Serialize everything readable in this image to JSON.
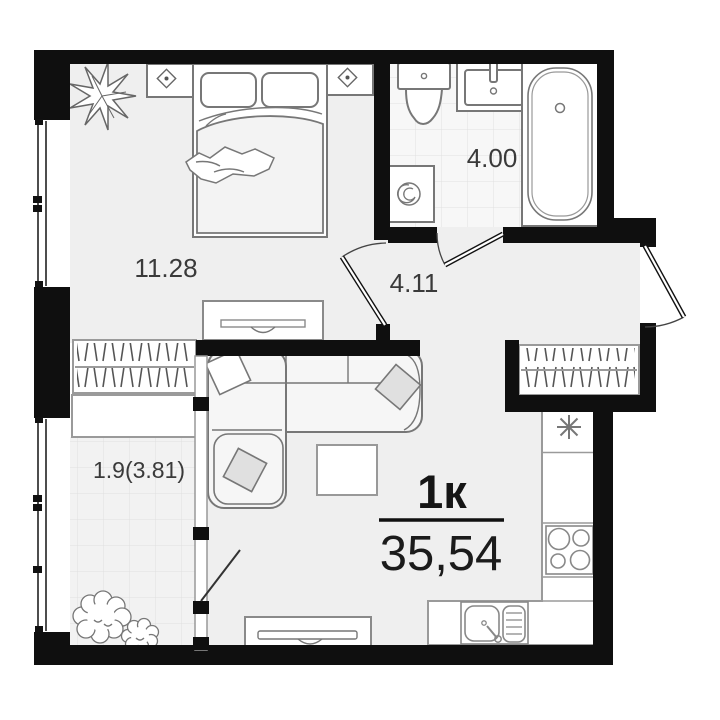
{
  "plan": {
    "apartment_type": "1к",
    "total_area": "35,54",
    "rooms": {
      "bedroom": {
        "name": "bedroom",
        "area": "11.28"
      },
      "bathroom": {
        "name": "bathroom",
        "area": "4.00"
      },
      "hall": {
        "name": "hall",
        "area": "4.11"
      },
      "balcony": {
        "name": "balcony",
        "area": "1.9(3.81)"
      }
    },
    "colors": {
      "wall": "#0f0f0f",
      "floor": "#efefef",
      "tile_floor": "#f5f5f5",
      "tile_line": "#e0e0e0",
      "furniture_stroke": "#777777",
      "counter_stroke": "#9a9a9a",
      "room_label": "#3a3a3a",
      "big_label": "#1b1b1b"
    },
    "icons": [
      "plant-icon",
      "bed-icon",
      "pillow-icon",
      "nightstand-lamp-icon",
      "dresser-icon",
      "wardrobe-icon",
      "toilet-icon",
      "washing-machine-icon",
      "wall-sink-icon",
      "bathtub-icon",
      "door-swing-icon",
      "entrance-door-icon",
      "balcony-door-icon",
      "window-icon",
      "sofa-icon",
      "coffee-table-icon",
      "tv-stand-icon",
      "kitchen-counter-icon",
      "vent-star-icon",
      "stove-icon",
      "kitchen-sink-icon",
      "bush-icon"
    ]
  }
}
